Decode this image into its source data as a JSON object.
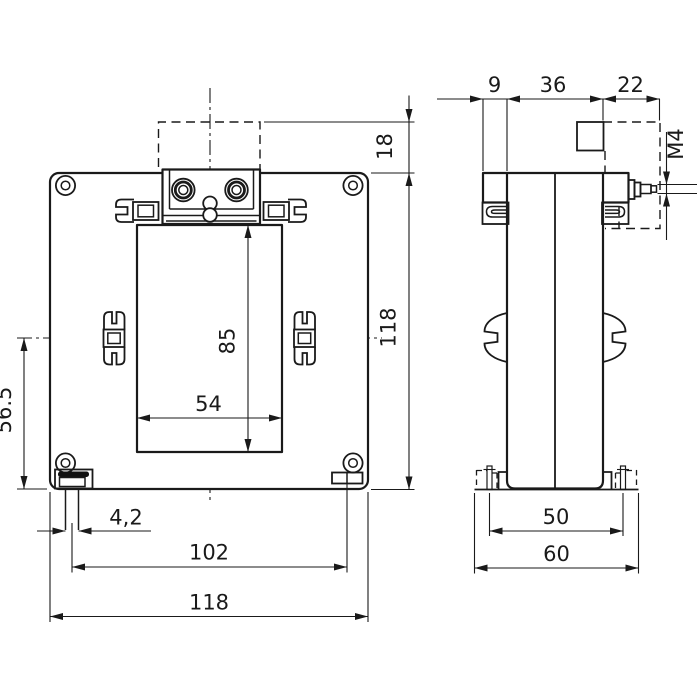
{
  "front_view": {
    "label": "front-view",
    "dims": {
      "protrusion": "18",
      "height": "118",
      "window_height": "85",
      "window_width": "54",
      "center_to_bottom": "56.5",
      "slot_width": "4,2",
      "foot_spacing": "102",
      "width": "118"
    }
  },
  "side_view": {
    "label": "side-view",
    "dims": {
      "flange_offset": "9",
      "depth": "36",
      "terminal_depth": "22",
      "thread": "M4",
      "base": "50",
      "overall": "60"
    }
  }
}
